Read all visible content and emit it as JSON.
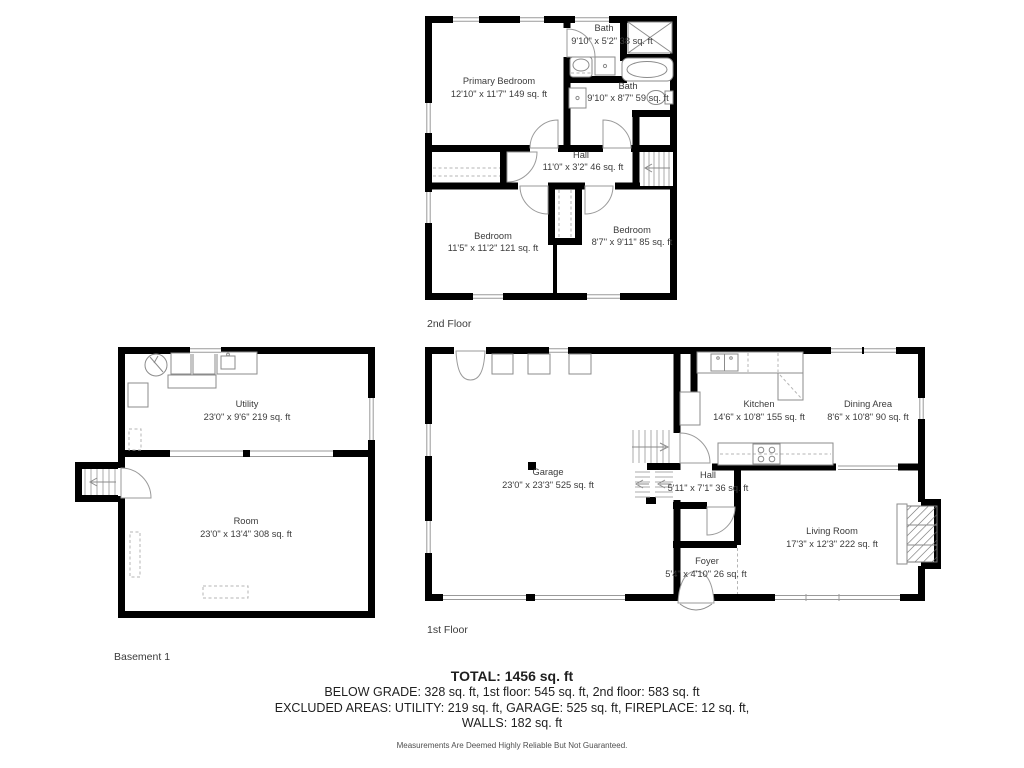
{
  "captions": {
    "second": "2nd Floor",
    "first": "1st Floor",
    "basement": "Basement 1"
  },
  "floors": {
    "second": {
      "rooms": {
        "bath_top": {
          "name": "Bath",
          "dims": "9'10\" x 5'2\" 38 sq. ft"
        },
        "primary_bedroom": {
          "name": "Primary Bedroom",
          "dims": "12'10\" x 11'7\" 149 sq. ft"
        },
        "bath_right": {
          "name": "Bath",
          "dims": "9'10\" x 8'7\" 59 sq. ft"
        },
        "hall": {
          "name": "Hall",
          "dims": "11'0\" x 3'2\" 46 sq. ft"
        },
        "bedroom_left": {
          "name": "Bedroom",
          "dims": "11'5\" x 11'2\" 121 sq. ft"
        },
        "bedroom_right": {
          "name": "Bedroom",
          "dims": "8'7\" x 9'11\" 85 sq. ft"
        }
      }
    },
    "first": {
      "rooms": {
        "garage": {
          "name": "Garage",
          "dims": "23'0\" x 23'3\" 525 sq. ft"
        },
        "kitchen": {
          "name": "Kitchen",
          "dims": "14'6\" x 10'8\" 155 sq. ft"
        },
        "dining": {
          "name": "Dining Area",
          "dims": "8'6\" x 10'8\" 90 sq. ft"
        },
        "hall": {
          "name": "Hall",
          "dims": "5'11\" x 7'1\" 36 sq. ft"
        },
        "foyer": {
          "name": "Foyer",
          "dims": "5'4\" x 4'10\" 26 sq. ft"
        },
        "living": {
          "name": "Living Room",
          "dims": "17'3\" x 12'3\" 222 sq. ft"
        }
      }
    },
    "basement": {
      "rooms": {
        "utility": {
          "name": "Utility",
          "dims": "23'0\" x 9'6\" 219 sq. ft"
        },
        "room": {
          "name": "Room",
          "dims": "23'0\" x 13'4\" 308 sq. ft"
        }
      }
    }
  },
  "summary": {
    "total": "TOTAL: 1456 sq. ft",
    "grade_line": "BELOW GRADE: 328 sq. ft, 1st floor: 545 sq. ft, 2nd floor: 583 sq. ft",
    "excluded_line": "EXCLUDED AREAS: UTILITY: 219 sq. ft, GARAGE: 525 sq. ft, FIREPLACE: 12 sq. ft,",
    "walls_line": "WALLS: 182 sq. ft",
    "disclaimer": "Measurements Are Deemed Highly Reliable But Not Guaranteed."
  },
  "colors": {
    "wall": "#000000",
    "label": "#3b3b3b",
    "fixture": "#8b8b8b"
  }
}
